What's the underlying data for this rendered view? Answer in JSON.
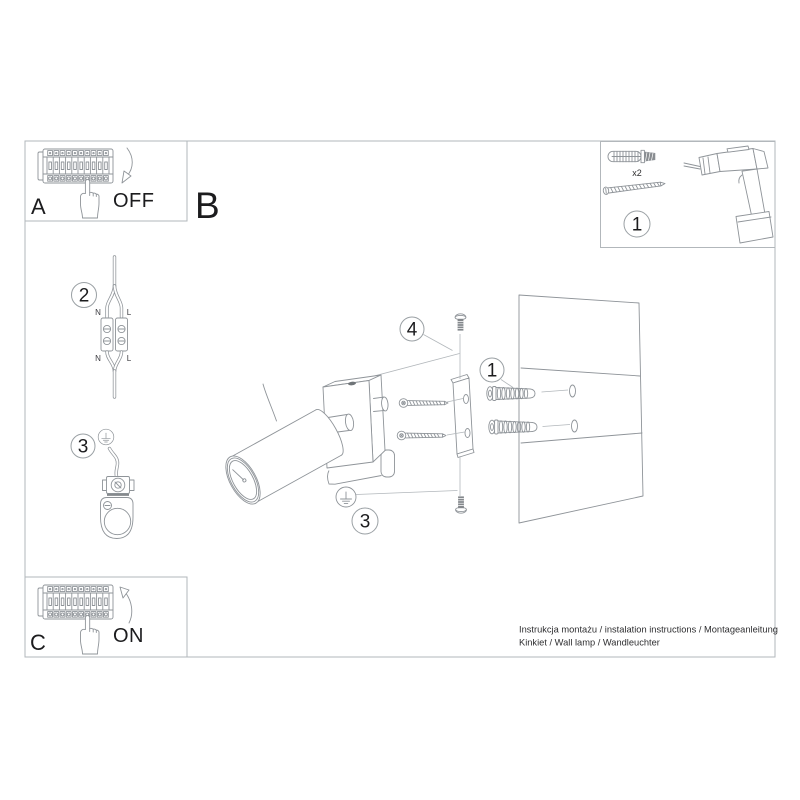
{
  "colors": {
    "line": "#8f9499",
    "line_light": "#b2b7bb",
    "ink": "#1c1c1e"
  },
  "steps": {
    "a": {
      "label": "A",
      "action": "OFF"
    },
    "b": {
      "label": "B"
    },
    "c": {
      "label": "C",
      "action": "ON"
    }
  },
  "parts_box": {
    "callout": "1",
    "anchor_qty": "x2"
  },
  "callouts": {
    "wiring": "2",
    "bracket_left": "3",
    "screw_axis": "4",
    "anchors": "1",
    "ground_bracket": "3"
  },
  "wiring_labels": {
    "top_n": "N",
    "top_l": "L",
    "bottom_n": "N",
    "bottom_l": "L"
  },
  "footer": {
    "line1": "Instrukcja montażu / instalation instructions / Montageanleitung",
    "line2": "Kinkiet / Wall lamp / Wandleuchter"
  }
}
